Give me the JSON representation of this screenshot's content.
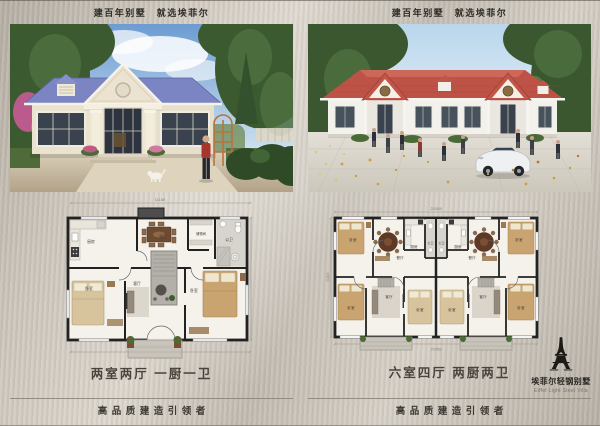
{
  "left": {
    "header": "建百年别墅　就选埃菲尔",
    "caption": "两室两厅 一厨一卫",
    "footer": "高品质建造引领者",
    "plan": {
      "dim_top": "11169",
      "dim_bottom": "11169",
      "dim_side": "8969",
      "rooms": {
        "kitchen": "厨房",
        "dining": "餐厅",
        "storage": "储物间",
        "bath": "公卫",
        "bedroom_left": "卧室",
        "living": "客厅",
        "bedroom_right": "卧室"
      }
    }
  },
  "right": {
    "header": "建百年别墅　就选埃菲尔",
    "caption": "六室四厅 两厨两卫",
    "footer": "高品质建造引领者",
    "plan": {
      "dim_top": "22058",
      "dim_bottom": "22058",
      "dim_side": "9283",
      "rooms": {
        "bedroom_top": "卧室",
        "dining": "餐厅",
        "kitchen": "厨房",
        "bath": "公卫",
        "bedroom_bottom": "卧室",
        "living": "客厅",
        "bedroom_mid": "卧室"
      }
    }
  },
  "brand": {
    "name": "埃菲尔轻钢别墅",
    "name_en": "Eiffel Light Steel Villa"
  },
  "colors": {
    "metal": "#cdc6bc",
    "left_roof": "#7b85c4",
    "right_roof": "#bd5347",
    "text": "#2f2d28"
  }
}
